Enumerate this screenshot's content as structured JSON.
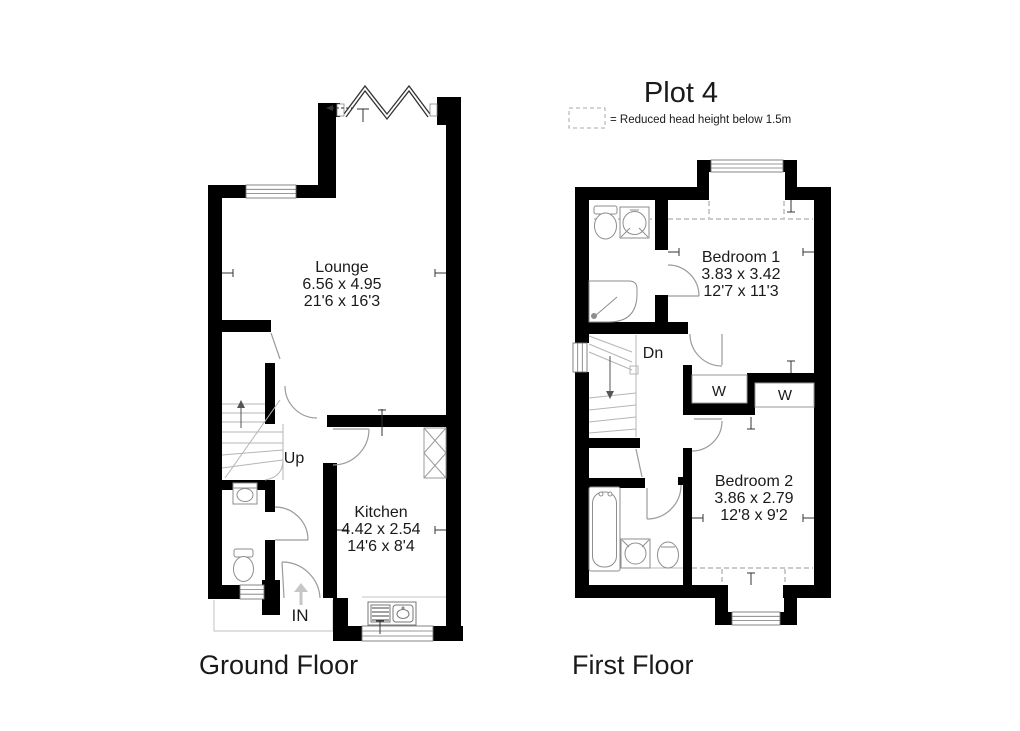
{
  "title": "Plot 4",
  "legend": {
    "label": "= Reduced head height below 1.5m"
  },
  "ground": {
    "title": "Ground Floor",
    "lounge": {
      "name": "Lounge",
      "metric": "6.56 x 4.95",
      "imperial": "21'6 x 16'3"
    },
    "kitchen": {
      "name": "Kitchen",
      "metric": "4.42 x 2.54",
      "imperial": "14'6 x 8'4"
    },
    "stairs_label": "Up",
    "entrance_label": "IN"
  },
  "first": {
    "title": "First Floor",
    "bedroom1": {
      "name": "Bedroom 1",
      "metric": "3.83 x 3.42",
      "imperial": "12'7 x 11'3"
    },
    "bedroom2": {
      "name": "Bedroom 2",
      "metric": "3.86 x 2.79",
      "imperial": "12'8 x 9'2"
    },
    "stairs_label": "Dn",
    "wardrobe1_label": "W",
    "wardrobe2_label": "W"
  },
  "colors": {
    "wall": "#000000",
    "fixture_line": "#8e8e8e",
    "text": "#1a1a1a"
  }
}
